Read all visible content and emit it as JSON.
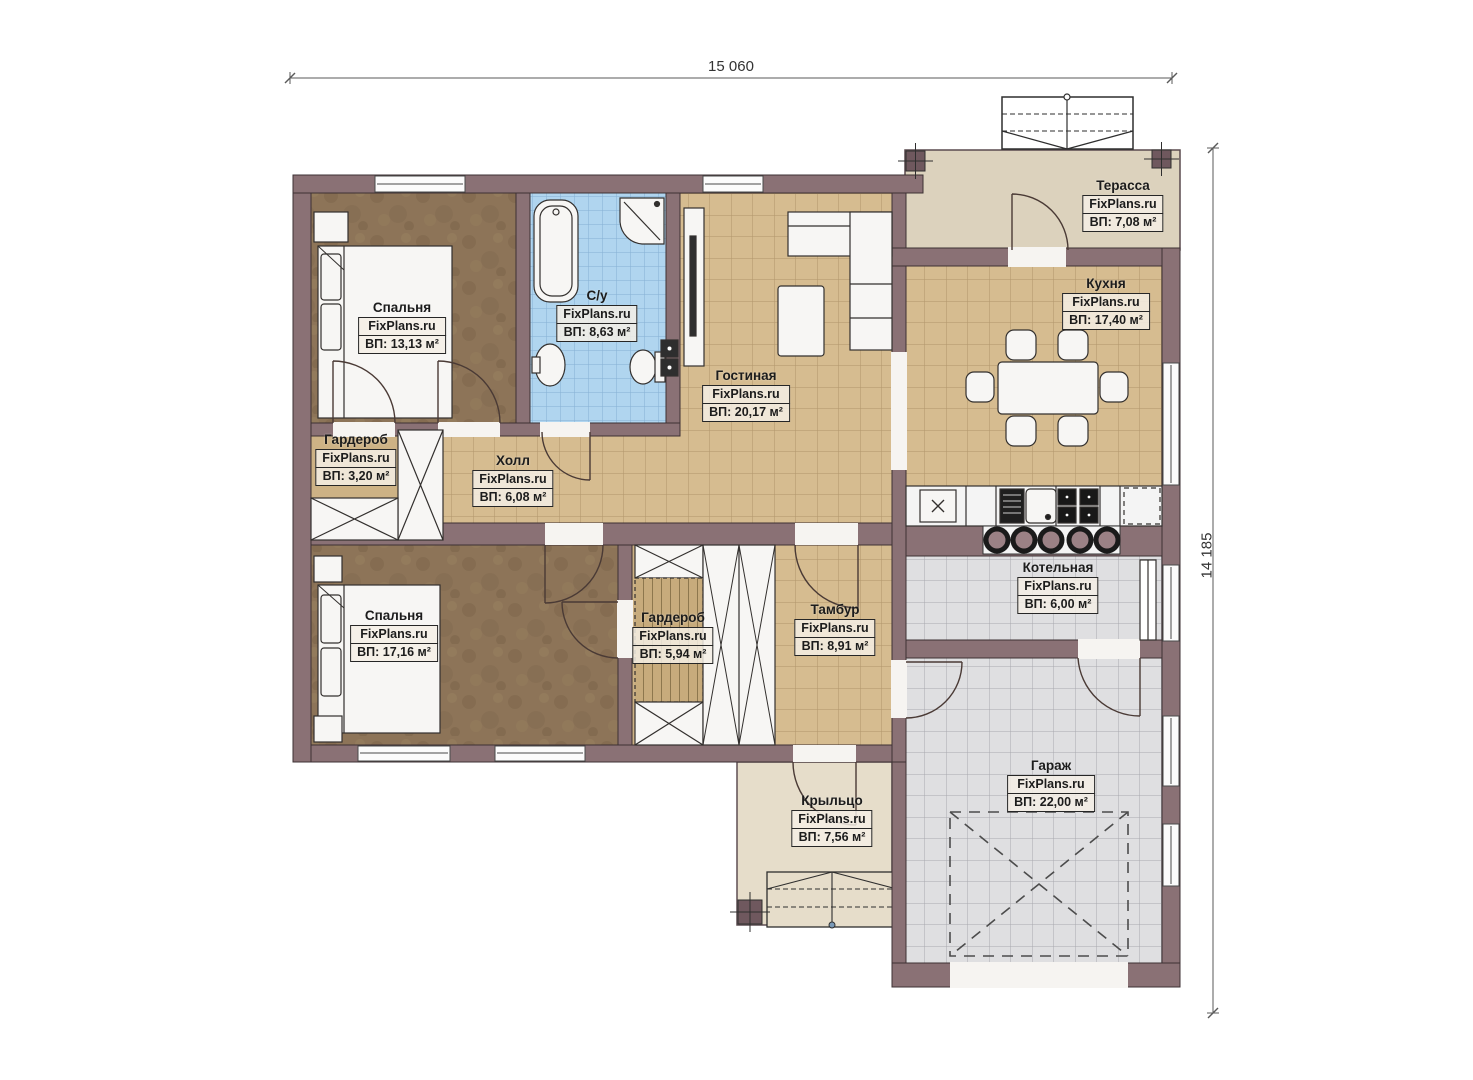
{
  "plan": {
    "site_watermark": "FixPlans.ru",
    "area_prefix": "ВП:",
    "dimensions": {
      "width_label": "15 060",
      "height_label": "14 185"
    },
    "palette": {
      "wall": "#8a7175",
      "wall_outline": "#3d3134",
      "tan_tile": "#d6bc90",
      "gray_tile": "#dfdfe1",
      "blue_tile": "#b0d5ef",
      "carpet": "#8d7458",
      "terrace": "#dcd2bd",
      "porch": "#e6ddca",
      "fixture": "#f7f6f4",
      "label_box_bg": "#f4efe5"
    }
  },
  "rooms": [
    {
      "id": "bedroom-1",
      "name": "Спальня",
      "site": "FixPlans.ru",
      "area": "ВП: 13,13 м²"
    },
    {
      "id": "bathroom",
      "name": "С/у",
      "site": "FixPlans.ru",
      "area": "ВП: 8,63 м²"
    },
    {
      "id": "living",
      "name": "Гостиная",
      "site": "FixPlans.ru",
      "area": "ВП: 20,17 м²"
    },
    {
      "id": "kitchen",
      "name": "Кухня",
      "site": "FixPlans.ru",
      "area": "ВП: 17,40 м²"
    },
    {
      "id": "terrace",
      "name": "Терасса",
      "site": "FixPlans.ru",
      "area": "ВП: 7,08 м²"
    },
    {
      "id": "wardrobe-1",
      "name": "Гардероб",
      "site": "FixPlans.ru",
      "area": "ВП: 3,20 м²"
    },
    {
      "id": "hall",
      "name": "Холл",
      "site": "FixPlans.ru",
      "area": "ВП: 6,08 м²"
    },
    {
      "id": "bedroom-2",
      "name": "Спальня",
      "site": "FixPlans.ru",
      "area": "ВП: 17,16 м²"
    },
    {
      "id": "wardrobe-2",
      "name": "Гардероб",
      "site": "FixPlans.ru",
      "area": "ВП: 5,94 м²"
    },
    {
      "id": "tambur",
      "name": "Тамбур",
      "site": "FixPlans.ru",
      "area": "ВП: 8,91 м²"
    },
    {
      "id": "boiler",
      "name": "Котельная",
      "site": "FixPlans.ru",
      "area": "ВП: 6,00 м²"
    },
    {
      "id": "garage",
      "name": "Гараж",
      "site": "FixPlans.ru",
      "area": "ВП: 22,00 м²"
    },
    {
      "id": "porch",
      "name": "Крыльцо",
      "site": "FixPlans.ru",
      "area": "ВП: 7,56 м²"
    }
  ]
}
